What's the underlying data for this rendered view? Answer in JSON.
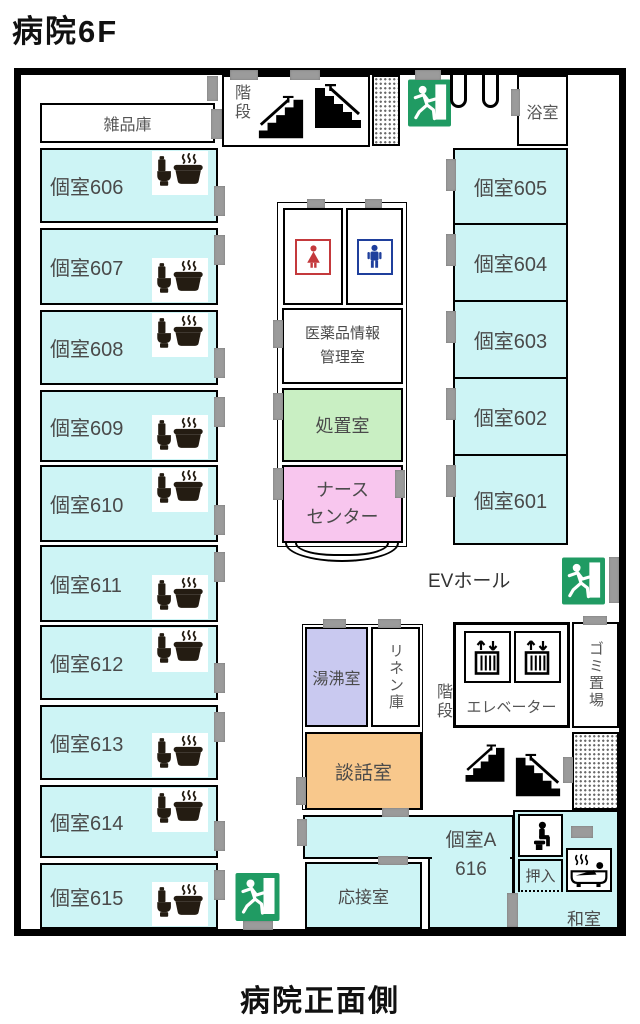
{
  "title": "病院6F",
  "bottom_caption": "病院正面側",
  "storage_room": {
    "label": "雑品庫"
  },
  "left_rooms": [
    {
      "label": "個室606"
    },
    {
      "label": "個室607"
    },
    {
      "label": "個室608"
    },
    {
      "label": "個室609"
    },
    {
      "label": "個室610"
    },
    {
      "label": "個室611"
    },
    {
      "label": "個室612"
    },
    {
      "label": "個室613"
    },
    {
      "label": "個室614"
    },
    {
      "label": "個室615"
    }
  ],
  "right_rooms": [
    {
      "label": "個室605"
    },
    {
      "label": "個室604"
    },
    {
      "label": "個室603"
    },
    {
      "label": "個室602"
    },
    {
      "label": "個室601"
    }
  ],
  "top_area": {
    "stairs_label": "階段",
    "bath_room_label": "浴室"
  },
  "center_block": {
    "pharma_line1": "医薬品情報",
    "pharma_line2": "管理室",
    "treatment_room": "処置室",
    "nurse_line1": "ナース",
    "nurse_line2": "センター"
  },
  "ev_hall_label": "EVホール",
  "lower_block": {
    "hot_water_room": "湯沸室",
    "linen_storage": "リネン庫",
    "lounge": "談話室",
    "stairs_label": "階段",
    "elevator_label": "エレベーター",
    "garbage_area": "ゴミ置場"
  },
  "bottom_rooms": {
    "reception_room": "応接室",
    "room_a_line1": "個室A",
    "room_a_line2": "616",
    "closet": "押入",
    "japanese_room": "和室"
  },
  "colors": {
    "room_cyan": "#cdf4f5",
    "treatment_green": "#c9efc3",
    "nurse_pink": "#f8c6ee",
    "hot_water_purple": "#c9c9f0",
    "lounge_orange": "#f8c88c",
    "exit_green": "#209b63",
    "wc_female_red": "#c4393c",
    "wc_male_blue": "#1f3f9c",
    "door_gray": "#9b9b9b"
  },
  "icons": {
    "exit": "emergency-exit-running-man",
    "stairs": "stairs-pictogram",
    "elevator": "elevator-cabin-with-arrows",
    "room_toilet_bath": "toilet-and-covered-bath",
    "wc_female": "female-figure",
    "wc_male": "male-figure",
    "toilet_seated": "seated-toilet-person",
    "bathtub": "person-in-bathtub"
  }
}
